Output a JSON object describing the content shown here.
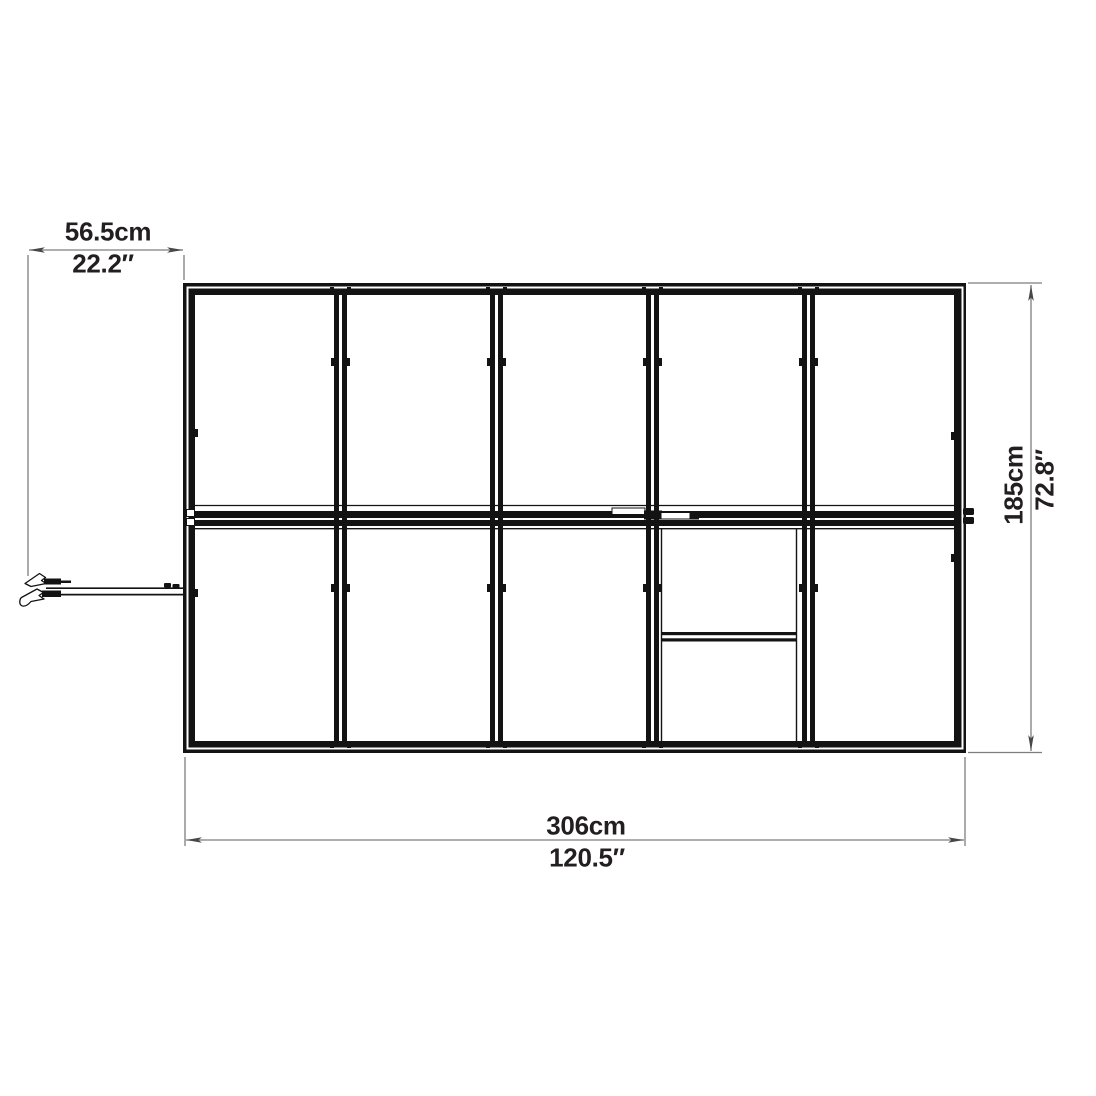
{
  "dimensions": {
    "left_offset": {
      "cm": "56.5cm",
      "in": "22.2″"
    },
    "depth": {
      "cm": "185cm",
      "in": "72.8″"
    },
    "width": {
      "cm": "306cm",
      "in": "120.5″"
    }
  },
  "structure": {
    "panel_columns": 5,
    "panel_rows": 2,
    "door_sections": 2
  },
  "colors": {
    "ink": "#131313",
    "dim": "#7e7e7e",
    "arrow": "#474747",
    "text": "#231f20",
    "bg": "#ffffff"
  }
}
